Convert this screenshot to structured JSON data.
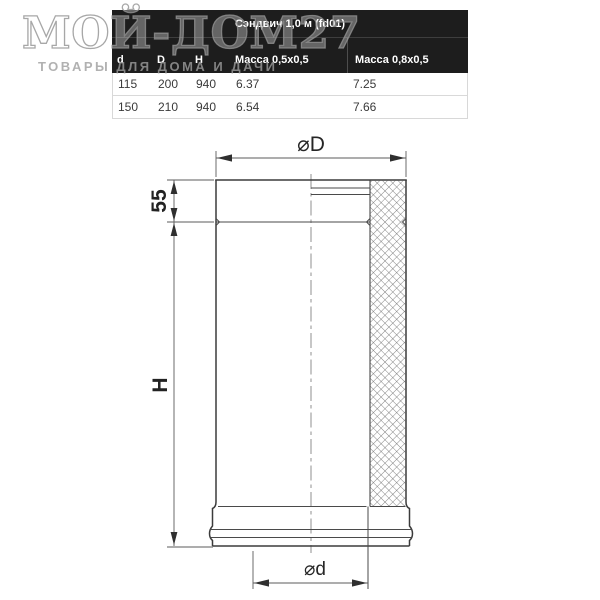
{
  "brand": {
    "logo_text": "МОЙ-ДОМ27",
    "tagline": "ТОВАРЫ ДЛЯ ДОМА И ДАЧИ"
  },
  "product_table": {
    "title": "Сэндвич 1,0 м (fd01)",
    "columns": [
      "d",
      "D",
      "H",
      "Масса 0,5x0,5",
      "Масса 0,8x0,5"
    ],
    "rows": [
      [
        "115",
        "200",
        "940",
        "6.37",
        "7.25"
      ],
      [
        "150",
        "210",
        "940",
        "6.54",
        "7.66"
      ]
    ]
  },
  "drawing": {
    "labels": {
      "outer_diameter": "⌀D",
      "collar_height": "55",
      "body_height": "H",
      "inner_diameter": "⌀d"
    }
  },
  "colors": {
    "table_header_bg": "#1d1d1d",
    "table_header_text": "#ffffff",
    "drawing_line": "#3b3b3b",
    "watermark_gray": "#bdbdbd"
  }
}
